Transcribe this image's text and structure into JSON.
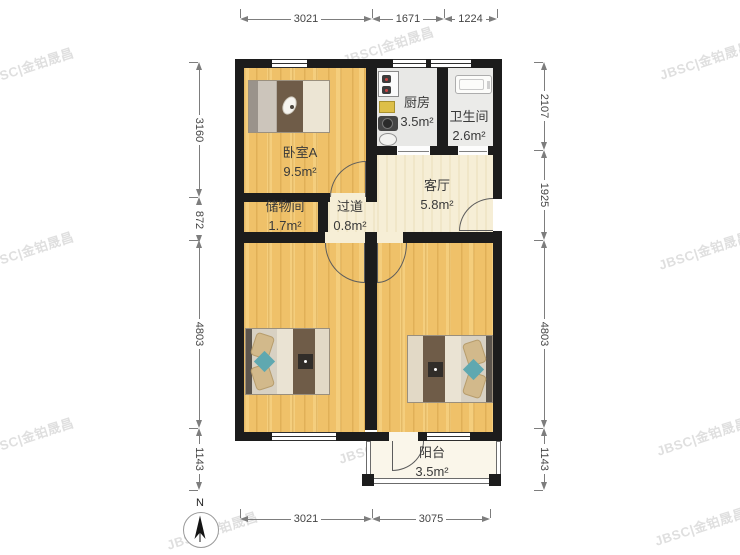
{
  "rooms": [
    {
      "name": "卧室A",
      "area": "9.5m²"
    },
    {
      "name": "厨房",
      "area": "3.5m²"
    },
    {
      "name": "卫生间",
      "area": "2.6m²"
    },
    {
      "name": "客厅",
      "area": "5.8m²"
    },
    {
      "name": "储物间",
      "area": "1.7m²"
    },
    {
      "name": "过道",
      "area": "0.8m²"
    },
    {
      "name": "阳台",
      "area": "3.5m²"
    }
  ],
  "dims": {
    "top": [
      "3021",
      "1671",
      "1224"
    ],
    "bottom": [
      "3021",
      "3075"
    ],
    "left": [
      "3160",
      "872",
      "4803",
      "1143"
    ],
    "right": [
      "2107",
      "1925",
      "4803",
      "1143"
    ]
  },
  "compass": {
    "north": "N"
  },
  "watermark": {
    "text": "JBSC|金铂晟昌"
  },
  "colors": {
    "wall": "#1c1c1c",
    "wood_floor": "#efc169",
    "living_floor": "#f6eed6",
    "tile_floor": "#e8e8e6",
    "teal_accent": "#5fa8b0"
  }
}
